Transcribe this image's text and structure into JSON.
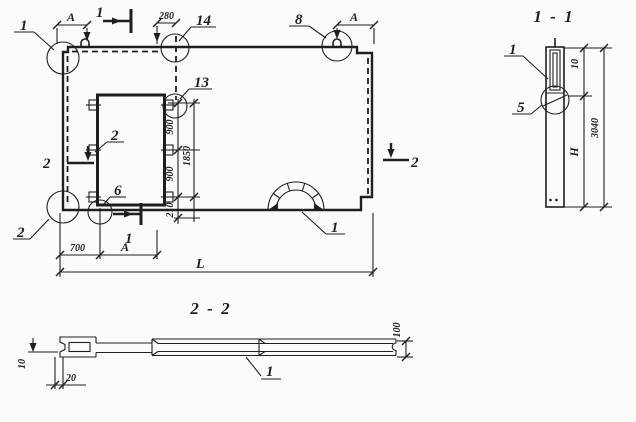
{
  "colors": {
    "ink": "#1f1f1f",
    "paper": "#fbfbf9"
  },
  "plan": {
    "callouts": {
      "corner_top_left": "1",
      "loop_top_right": "8",
      "embed_top": "14",
      "embed_lower": "13",
      "anchor_middle": "2",
      "anchor_bottom": "6",
      "corner_bottom_left": "2",
      "arch": "1"
    },
    "section_marks": {
      "s1_top": "1",
      "s1_bottom": "1",
      "s2_left": "2",
      "s2_right": "2"
    },
    "dims": {
      "a_top_left": "А",
      "offset_280": "280",
      "a_top_right": "А",
      "v_900_upper": "900",
      "v_1850": "1850",
      "v_900_lower": "900",
      "v_210": "210",
      "h_700": "700",
      "h_a": "А",
      "h_length": "L"
    }
  },
  "section_1_1": {
    "title": "1 - 1",
    "callouts": {
      "edge": "1",
      "joint": "5"
    },
    "dims": {
      "top": "10",
      "height": "Н",
      "overall": "3040"
    }
  },
  "section_2_2": {
    "title": "2 - 2",
    "callouts": {
      "slab": "1"
    },
    "dims": {
      "lip_height": "10",
      "lip_width": "20",
      "thickness": "100"
    }
  }
}
